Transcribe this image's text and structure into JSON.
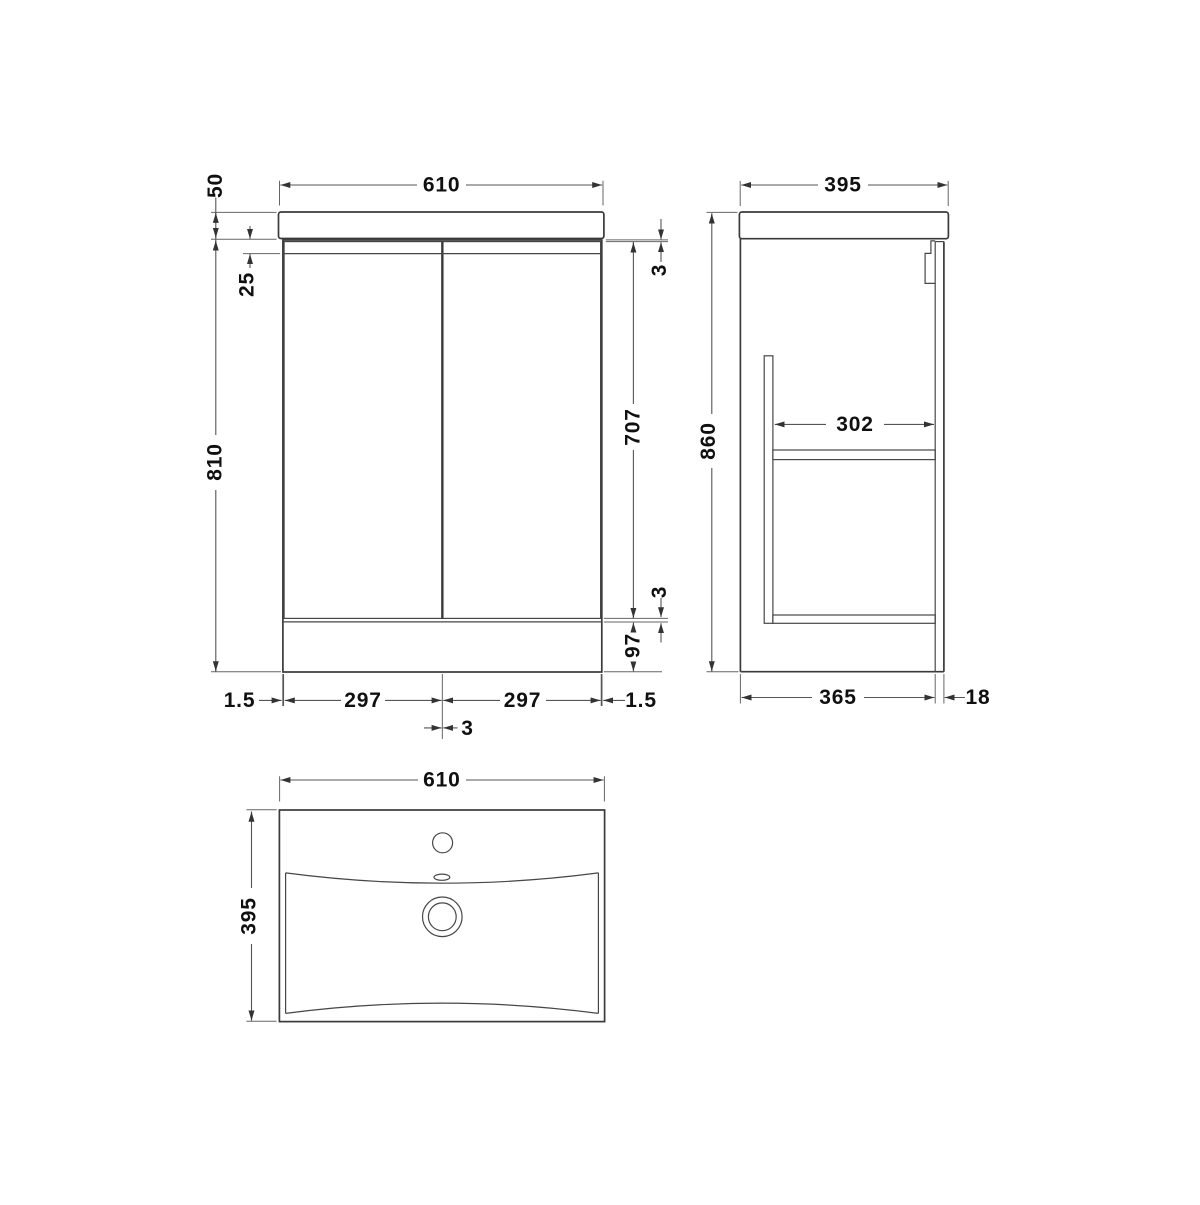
{
  "drawing": {
    "title": "vanity-unit-with-basin-technical-drawing",
    "front": {
      "width": "610",
      "basin_thickness": "50",
      "handle_offset": "25",
      "cabinet_height": "810",
      "door_height": "707",
      "gap_top": "3",
      "gap_bottom": "3",
      "plinth_height": "97",
      "edge_left": "1.5",
      "door_left": "297",
      "door_right": "297",
      "edge_right": "1.5",
      "center_gap": "3"
    },
    "side": {
      "depth": "395",
      "total_height": "860",
      "internal_depth": "302",
      "base_depth": "365",
      "door_thickness": "18"
    },
    "top": {
      "width": "610",
      "depth": "395"
    }
  }
}
